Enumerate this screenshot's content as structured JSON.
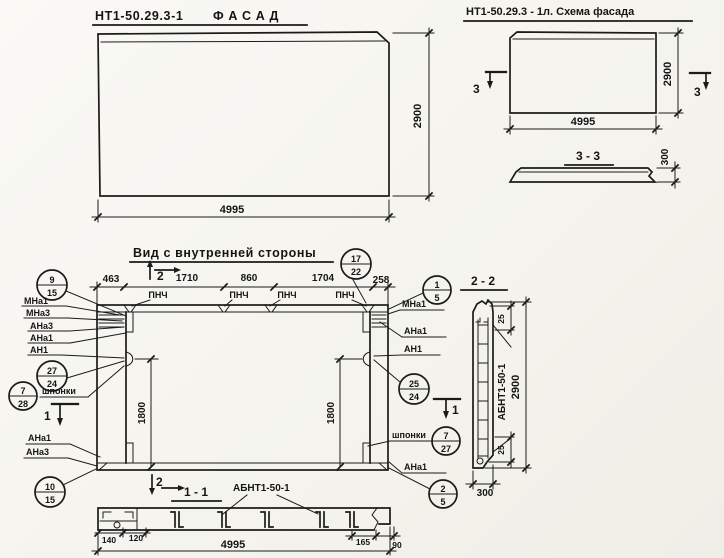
{
  "colors": {
    "paper": "#f6f5f0",
    "ink": "#1b1b1b"
  },
  "facade": {
    "code": "НТ1-50.29.3-1",
    "name": "Ф А С А Д",
    "dim_width": "4995",
    "dim_height": "2900"
  },
  "schema": {
    "title": "НТ1-50.29.3 - 1л. Схема фасада",
    "dim_width": "4995",
    "dim_height": "2900",
    "cut": "3",
    "section_title": "3 - 3",
    "dim_thickness": "300"
  },
  "inner": {
    "title": "Вид с внутренней стороны",
    "dims_top": [
      "463",
      "1710",
      "860",
      "1704",
      "258"
    ],
    "pnch": "ПНЧ",
    "cut1": "1",
    "cut2": "2",
    "dim_1800_left": "1800",
    "dim_1800_right": "1800",
    "labels_left": [
      "МНа1",
      "МНа3",
      "АНа3",
      "АНа1",
      "АН1"
    ],
    "labels_left_bottom": [
      "АНа1",
      "АНа3"
    ],
    "labels_right": [
      "МНа1",
      "АНа1",
      "АН1"
    ],
    "label_right_bottom": "АНа1",
    "keys": "шпонки",
    "callouts": {
      "c9_15": {
        "t": "9",
        "b": "15"
      },
      "c27_24": {
        "t": "27",
        "b": "24"
      },
      "c7_28": {
        "t": "7",
        "b": "28"
      },
      "c10_15": {
        "t": "10",
        "b": "15"
      },
      "c17_22": {
        "t": "17",
        "b": "22"
      },
      "c1_5": {
        "t": "1",
        "b": "5"
      },
      "c25_24": {
        "t": "25",
        "b": "24"
      },
      "c7_27": {
        "t": "7",
        "b": "27"
      },
      "c2_5": {
        "t": "2",
        "b": "5"
      }
    }
  },
  "s11": {
    "title": "1 - 1",
    "mesh": "АБНТ1-50-1",
    "d140": "140",
    "d120": "120",
    "d165": "165",
    "d90": "90",
    "total": "4995"
  },
  "s22": {
    "title": "2 - 2",
    "mesh": "АБНТ1-50-1",
    "top25": "25",
    "bot25": "25",
    "dim_height": "2900",
    "dim_width": "300"
  }
}
